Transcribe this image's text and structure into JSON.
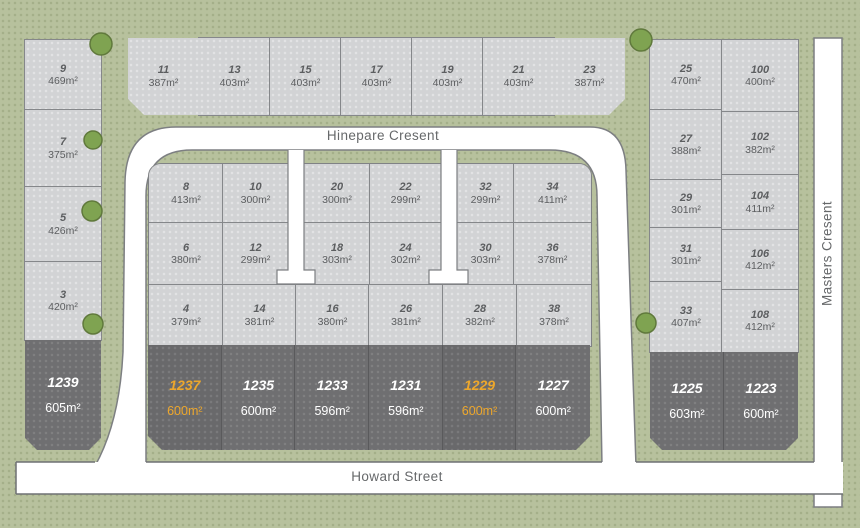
{
  "streets": {
    "north": "Hinepare Cresent",
    "south": "Howard Street",
    "east": "Masters Cresent"
  },
  "colors": {
    "ground": "#b7c19d",
    "available_lot": "#d2d3d5",
    "featured_lot": "#6f6f71",
    "highlight_text": "#eda72c",
    "road": "#ffffff",
    "tree": "#7fa351",
    "lot_text": "#5c5e60"
  },
  "groups": {
    "west_column": [
      {
        "number": "9",
        "area": "469m²"
      },
      {
        "number": "7",
        "area": "375m²"
      },
      {
        "number": "5",
        "area": "426m²"
      },
      {
        "number": "3",
        "area": "420m²"
      }
    ],
    "west_dark": [
      {
        "number": "1239",
        "area": "605m²",
        "highlight": false
      }
    ],
    "north_row": [
      {
        "number": "11",
        "area": "387m²"
      },
      {
        "number": "13",
        "area": "403m²"
      },
      {
        "number": "15",
        "area": "403m²"
      },
      {
        "number": "17",
        "area": "403m²"
      },
      {
        "number": "19",
        "area": "403m²"
      },
      {
        "number": "21",
        "area": "403m²"
      },
      {
        "number": "23",
        "area": "387m²"
      }
    ],
    "inner_row1": [
      {
        "number": "8",
        "area": "413m²"
      },
      {
        "number": "10",
        "area": "300m²"
      },
      {
        "number": "20",
        "area": "300m²"
      },
      {
        "number": "22",
        "area": "299m²"
      },
      {
        "number": "32",
        "area": "299m²"
      },
      {
        "number": "34",
        "area": "411m²"
      }
    ],
    "inner_row2": [
      {
        "number": "6",
        "area": "380m²"
      },
      {
        "number": "12",
        "area": "299m²"
      },
      {
        "number": "18",
        "area": "303m²"
      },
      {
        "number": "24",
        "area": "302m²"
      },
      {
        "number": "30",
        "area": "303m²"
      },
      {
        "number": "36",
        "area": "378m²"
      }
    ],
    "inner_row3": [
      {
        "number": "4",
        "area": "379m²"
      },
      {
        "number": "14",
        "area": "381m²"
      },
      {
        "number": "16",
        "area": "380m²"
      },
      {
        "number": "26",
        "area": "381m²"
      },
      {
        "number": "28",
        "area": "382m²"
      },
      {
        "number": "38",
        "area": "378m²"
      }
    ],
    "inner_dark": [
      {
        "number": "1237",
        "area": "600m²",
        "highlight": true
      },
      {
        "number": "1235",
        "area": "600m²",
        "highlight": false
      },
      {
        "number": "1233",
        "area": "596m²",
        "highlight": false
      },
      {
        "number": "1231",
        "area": "596m²",
        "highlight": false
      },
      {
        "number": "1229",
        "area": "600m²",
        "highlight": true
      },
      {
        "number": "1227",
        "area": "600m²",
        "highlight": false
      }
    ],
    "east_col1": [
      {
        "number": "25",
        "area": "470m²"
      },
      {
        "number": "27",
        "area": "388m²"
      },
      {
        "number": "29",
        "area": "301m²"
      },
      {
        "number": "31",
        "area": "301m²"
      },
      {
        "number": "33",
        "area": "407m²"
      }
    ],
    "east_col2": [
      {
        "number": "100",
        "area": "400m²"
      },
      {
        "number": "102",
        "area": "382m²"
      },
      {
        "number": "104",
        "area": "411m²"
      },
      {
        "number": "106",
        "area": "412m²"
      },
      {
        "number": "108",
        "area": "412m²"
      }
    ],
    "east_dark": [
      {
        "number": "1225",
        "area": "603m²",
        "highlight": false
      },
      {
        "number": "1223",
        "area": "600m²",
        "highlight": false
      }
    ]
  }
}
